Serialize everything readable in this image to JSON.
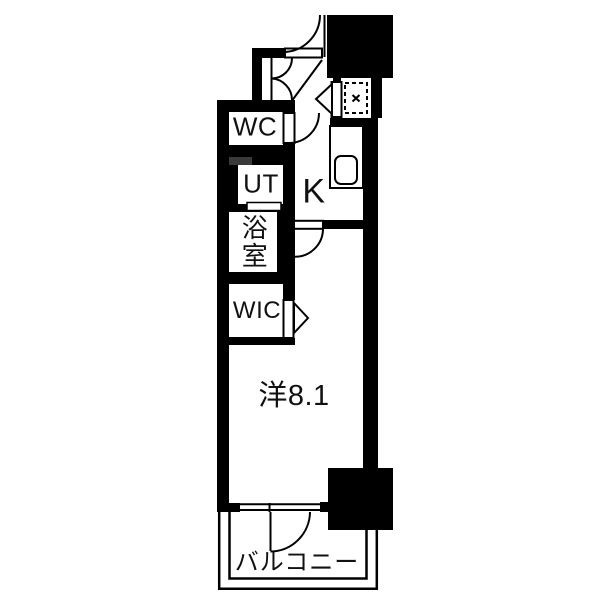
{
  "floorplan": {
    "rooms": {
      "wc": "WC",
      "ut": "UT",
      "bathroom": "浴室",
      "wic": "WIC",
      "kitchen": "K",
      "western_room": "洋8.1",
      "balcony": "バルコニー"
    },
    "colors": {
      "wall": "#000000",
      "background": "#ffffff",
      "shelf": "#3a3a3a"
    }
  }
}
